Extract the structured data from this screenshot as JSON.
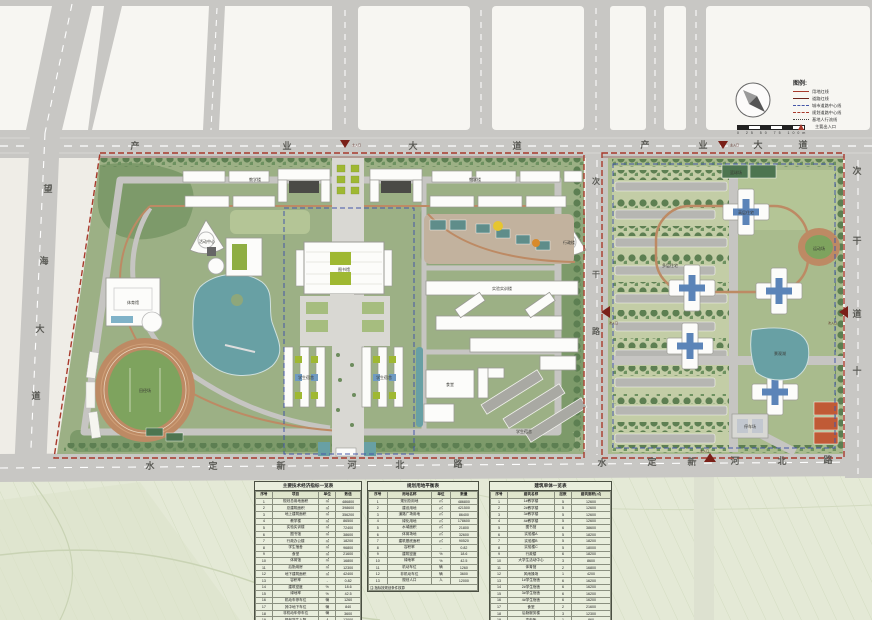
{
  "map": {
    "roads": {
      "top": {
        "name": "产业大道",
        "chars": [
          "产",
          "业",
          "大",
          "道"
        ]
      },
      "left": {
        "name": "望海大道",
        "chars": [
          "望",
          "海",
          "大",
          "道"
        ]
      },
      "bottom": {
        "name": "水定新河北路",
        "chars": [
          "水",
          "定",
          "新",
          "河",
          "北",
          "路"
        ]
      },
      "mid_vertical": {
        "name": "次干路",
        "chars": [
          "次",
          "干",
          "路"
        ]
      },
      "right_vertical": {
        "name": "次干道",
        "chars": [
          "次",
          "干",
          "道",
          "十"
        ]
      }
    },
    "markers": {
      "main_entrance": "主入口",
      "secondary_entrance": "次入口"
    },
    "west_campus": {
      "labels": {
        "teaching_a": "教学楼",
        "teaching_b": "教学楼",
        "activity": "活动中心",
        "admin": "行政楼",
        "library": "图书馆",
        "labs": "实验实训楼",
        "dorm_a": "学生宿舍",
        "dorm_b": "学生宿舍",
        "dorm_c": "学生宿舍",
        "canteen": "食堂",
        "gym": "体育馆",
        "stadium": "田径场"
      }
    },
    "east_campus": {
      "labels": {
        "residence": "高层住宅",
        "rows": "多层住宅",
        "lake": "景观湖",
        "track": "运动场",
        "parking": "停车场",
        "courts": "篮球场"
      }
    }
  },
  "legend": {
    "title": "图例:",
    "scale_text": "0  25  50  75  100m",
    "items": [
      {
        "type": "solid",
        "color": "#a83a2c",
        "label": "用地红线"
      },
      {
        "type": "solid",
        "color": "#6d241c",
        "label": "道路红线"
      },
      {
        "type": "dash",
        "color": "#4456a8",
        "label": "城市道路中心线"
      },
      {
        "type": "dash",
        "color": "#a83a2c",
        "label": "规划道路中心线"
      },
      {
        "type": "dot",
        "color": "#444444",
        "label": "基地人行流线"
      },
      {
        "type": "tri",
        "color": "#a83a2c",
        "label": "主要出入口"
      }
    ]
  },
  "tables": [
    {
      "title": "主要技术经济指标一览表",
      "headers": [
        "序号",
        "项目",
        "单位",
        "数值"
      ],
      "rows": [
        [
          "1",
          "规划总用地面积",
          "㎡",
          "486800"
        ],
        [
          "2",
          "总建筑面积",
          "㎡",
          "398600"
        ],
        [
          "3",
          "地上建筑面积",
          "㎡",
          "356200"
        ],
        [
          "4",
          "教学楼",
          "㎡",
          "86500"
        ],
        [
          "5",
          "实验实训楼",
          "㎡",
          "72400"
        ],
        [
          "6",
          "图书馆",
          "㎡",
          "38600"
        ],
        [
          "7",
          "行政办公楼",
          "㎡",
          "18200"
        ],
        [
          "8",
          "学生宿舍",
          "㎡",
          "96800"
        ],
        [
          "9",
          "食堂",
          "㎡",
          "21600"
        ],
        [
          "10",
          "体育馆",
          "㎡",
          "16800"
        ],
        [
          "11",
          "后勤用房",
          "㎡",
          "12300"
        ],
        [
          "12",
          "地下建筑面积",
          "㎡",
          "42400"
        ],
        [
          "13",
          "容积率",
          "-",
          "0.82"
        ],
        [
          "14",
          "建筑密度",
          "%",
          "18.6"
        ],
        [
          "15",
          "绿地率",
          "%",
          "42.5"
        ],
        [
          "16",
          "机动车停车位",
          "辆",
          "1260"
        ],
        [
          "17",
          "其中地下车位",
          "辆",
          "840"
        ],
        [
          "18",
          "非机动车停车位",
          "辆",
          "3600"
        ],
        [
          "19",
          "规划学生人数",
          "人",
          "12000"
        ]
      ],
      "footer": "注:面积单位均为平方米"
    },
    {
      "title": "规划用地平衡表",
      "headers": [
        "序号",
        "用地名称",
        "单位",
        "数量"
      ],
      "rows": [
        [
          "1",
          "规划总用地",
          "㎡",
          "486800"
        ],
        [
          "2",
          "建设用地",
          "㎡",
          "421500"
        ],
        [
          "3",
          "道路广场用地",
          "㎡",
          "86400"
        ],
        [
          "4",
          "绿化用地",
          "㎡",
          "178600"
        ],
        [
          "5",
          "水域面积",
          "㎡",
          "21800"
        ],
        [
          "6",
          "体育场地",
          "㎡",
          "32600"
        ],
        [
          "7",
          "建筑基底面积",
          "㎡",
          "90520"
        ],
        [
          "8",
          "容积率",
          "-",
          "0.82"
        ],
        [
          "9",
          "建筑密度",
          "%",
          "18.6"
        ],
        [
          "10",
          "绿地率",
          "%",
          "42.5"
        ],
        [
          "11",
          "机动车位",
          "辆",
          "1260"
        ],
        [
          "12",
          "非机动车位",
          "辆",
          "3600"
        ],
        [
          "13",
          "规划人口",
          "人",
          "12000"
        ]
      ],
      "footer": "注:指标按规划条件核算"
    },
    {
      "title": "建筑单体一览表",
      "headers": [
        "序号",
        "建筑名称",
        "层数",
        "建筑面积(㎡)"
      ],
      "rows": [
        [
          "1",
          "1#教学楼",
          "5",
          "12600"
        ],
        [
          "2",
          "2#教学楼",
          "5",
          "12600"
        ],
        [
          "3",
          "3#教学楼",
          "5",
          "12600"
        ],
        [
          "4",
          "4#教学楼",
          "5",
          "12600"
        ],
        [
          "5",
          "图书馆",
          "6",
          "38600"
        ],
        [
          "6",
          "实验楼A",
          "5",
          "18200"
        ],
        [
          "7",
          "实验楼B",
          "5",
          "18200"
        ],
        [
          "8",
          "实验楼C",
          "5",
          "18000"
        ],
        [
          "9",
          "行政楼",
          "6",
          "18200"
        ],
        [
          "10",
          "大学生活动中心",
          "3",
          "8600"
        ],
        [
          "11",
          "体育馆",
          "2",
          "16800"
        ],
        [
          "12",
          "风雨操场",
          "1",
          "4200"
        ],
        [
          "13",
          "1#学生宿舍",
          "6",
          "16200"
        ],
        [
          "14",
          "2#学生宿舍",
          "6",
          "16200"
        ],
        [
          "15",
          "3#学生宿舍",
          "6",
          "16200"
        ],
        [
          "16",
          "4#学生宿舍",
          "6",
          "16200"
        ],
        [
          "17",
          "食堂",
          "2",
          "21600"
        ],
        [
          "18",
          "后勤服务楼",
          "3",
          "12300"
        ],
        [
          "19",
          "变电所",
          "1",
          "860"
        ],
        [
          "20",
          "门卫",
          "1",
          "120"
        ]
      ],
      "footer": "注:面积为地上计容建筑面积"
    }
  ]
}
